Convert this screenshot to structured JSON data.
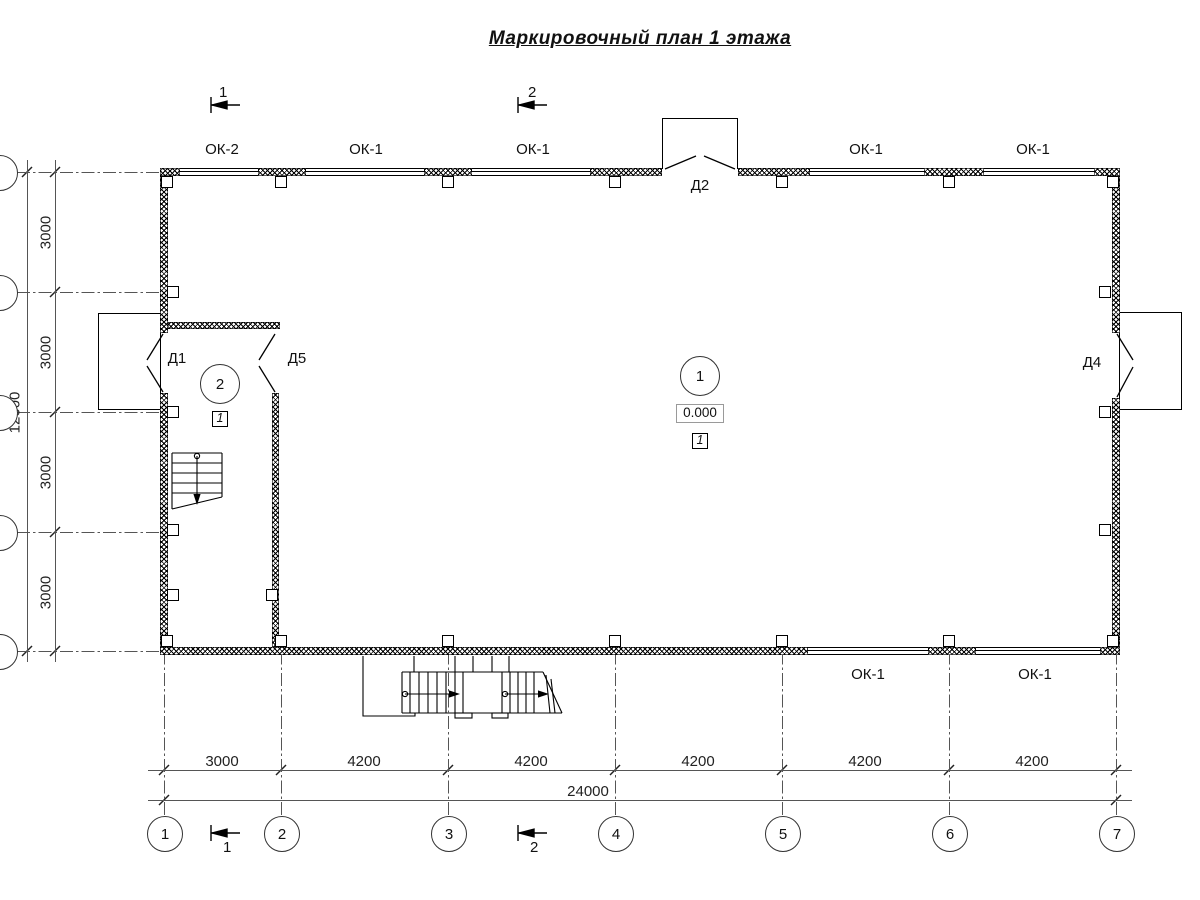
{
  "title": "Маркировочный план 1 этажа",
  "sections": {
    "top1": "1",
    "top2": "2",
    "bottom1": "1",
    "bottom2": "2"
  },
  "window_labels": {
    "top": [
      "ОК-2",
      "ОК-1",
      "ОК-1",
      "ОК-1",
      "ОК-1"
    ],
    "bottom": [
      "ОК-1",
      "ОК-1"
    ]
  },
  "door_labels": {
    "d1": "Д1",
    "d2": "Д2",
    "d4": "Д4",
    "d5": "Д5"
  },
  "room_numbers": {
    "main": "1",
    "stair": "2"
  },
  "level_mark": "0.000",
  "floor_markers": {
    "main": "1",
    "stair": "1"
  },
  "dimensions": {
    "bottom_segments": [
      "3000",
      "4200",
      "4200",
      "4200",
      "4200",
      "4200"
    ],
    "bottom_total": "24000",
    "left_segments": [
      "3000",
      "3000",
      "3000",
      "3000"
    ],
    "left_total": "12000"
  },
  "grid_axes": {
    "columns": [
      "1",
      "2",
      "3",
      "4",
      "5",
      "6",
      "7"
    ]
  }
}
